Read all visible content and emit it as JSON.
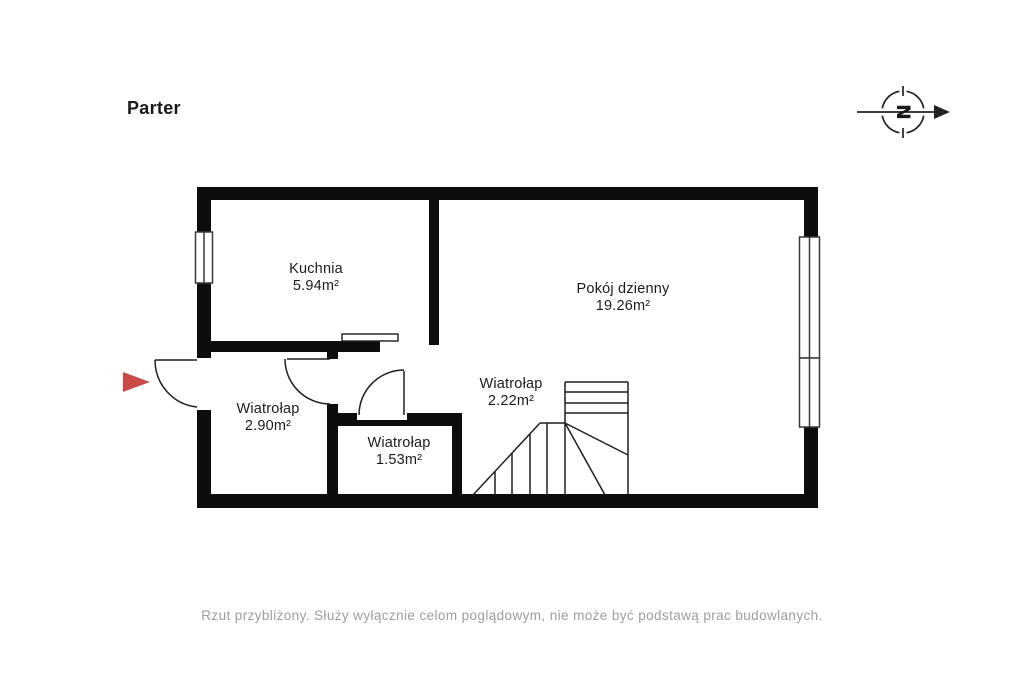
{
  "title": "Parter",
  "compass": {
    "letter": "N"
  },
  "rooms": [
    {
      "name": "Kuchnia",
      "area": "5.94m²"
    },
    {
      "name": "Pokój dzienny",
      "area": "19.26m²"
    },
    {
      "name": "Wiatrołap",
      "area": "2.90m²"
    },
    {
      "name": "Wiatrołap",
      "area": "1.53m²"
    },
    {
      "name": "Wiatrołap",
      "area": "2.22m²"
    }
  ],
  "disclaimer": "Rzut przybliżony. Służy wyłącznie celom poglądowym, nie może być podstawą prac budowlanych.",
  "colors": {
    "wall": "#0d0d0d",
    "line": "#1f1f1f",
    "entry_arrow": "#c94b45",
    "disclaimer_text": "#9d9d9d"
  }
}
